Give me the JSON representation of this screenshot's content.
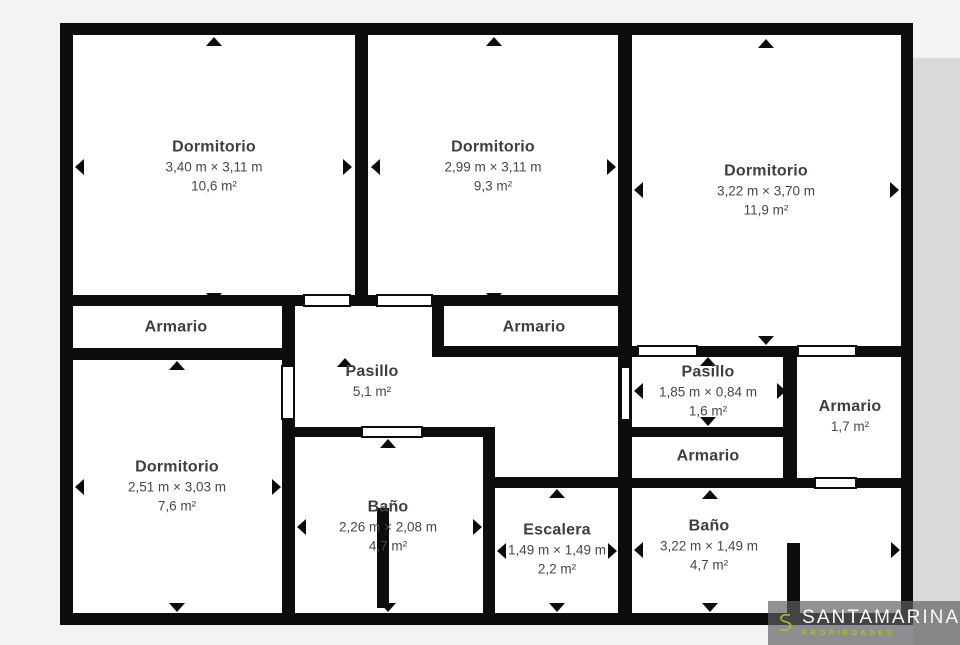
{
  "rooms": {
    "dormitorio_top_left": {
      "name": "Dormitorio",
      "dims": "3,40 m × 3,11 m",
      "area": "10,6 m²"
    },
    "dormitorio_top_mid": {
      "name": "Dormitorio",
      "dims": "2,99 m × 3,11 m",
      "area": "9,3 m²"
    },
    "dormitorio_top_right": {
      "name": "Dormitorio",
      "dims": "3,22 m × 3,70 m",
      "area": "11,9 m²"
    },
    "armario_left": {
      "name": "Armario"
    },
    "pasillo_main": {
      "name": "Pasillo",
      "area": "5,1 m²"
    },
    "armario_mid": {
      "name": "Armario"
    },
    "pasillo_small": {
      "name": "Pasillo",
      "dims": "1,85 m × 0,84 m",
      "area": "1,6 m²"
    },
    "armario_right": {
      "name": "Armario",
      "area": "1,7 m²"
    },
    "armario_small": {
      "name": "Armario"
    },
    "dormitorio_bottom_left": {
      "name": "Dormitorio",
      "dims": "2,51 m × 3,03 m",
      "area": "7,6 m²"
    },
    "bano_mid": {
      "name": "Baño",
      "dims": "2,26 m × 2,08 m",
      "area": "4,7 m²"
    },
    "escalera": {
      "name": "Escalera",
      "dims": "1,49 m × 1,49 m",
      "area": "2,2 m²"
    },
    "bano_right": {
      "name": "Baño",
      "dims": "3,22 m × 1,49 m",
      "area": "4,7 m²"
    }
  },
  "branding": {
    "name": "SANTAMARINA",
    "tagline": "PROPIEDADES"
  },
  "colors": {
    "wall": "#0d0d0d",
    "label": "#3c4043",
    "accent": "#b6bb2e",
    "side_band": "#d9d9d9",
    "background": "#f3f3f3"
  }
}
